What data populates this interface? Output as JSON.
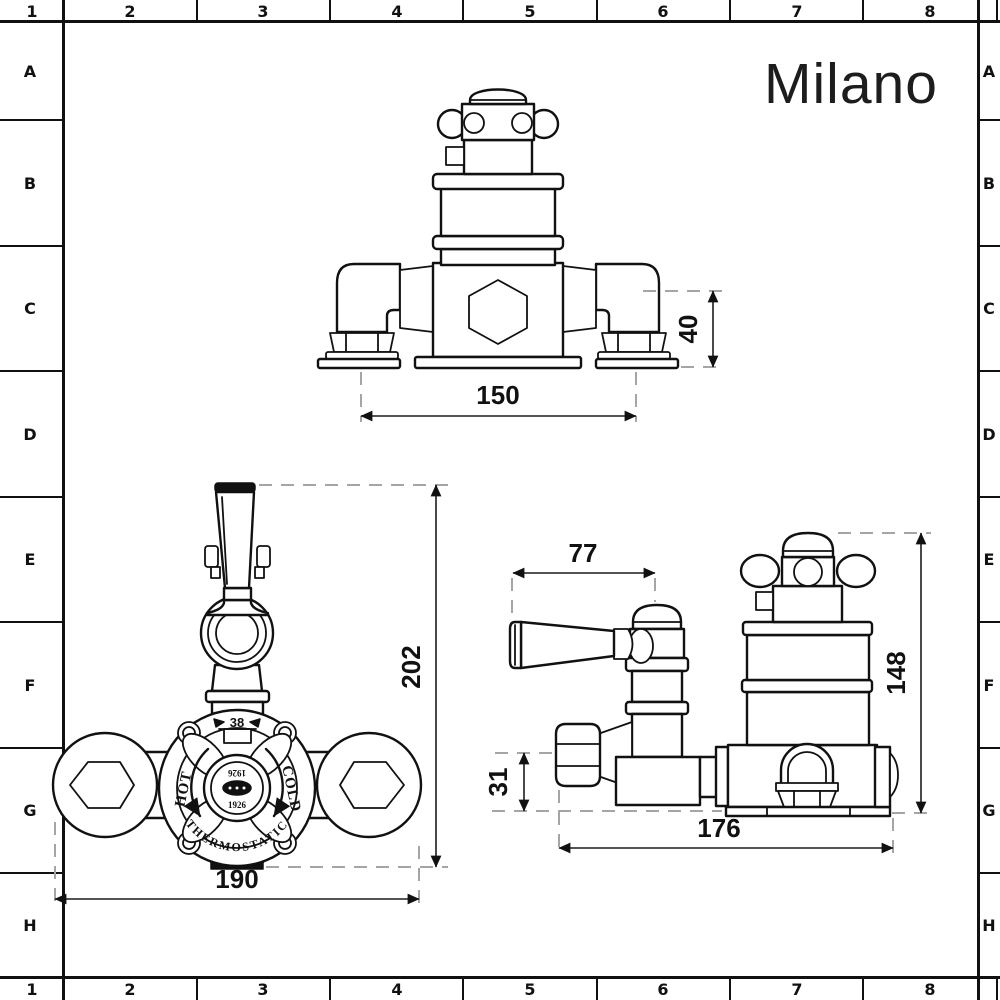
{
  "brand": {
    "logo": "Milano"
  },
  "grid": {
    "columns": [
      "1",
      "2",
      "3",
      "4",
      "5",
      "6",
      "7",
      "8"
    ],
    "rows": [
      "A",
      "B",
      "C",
      "D",
      "E",
      "F",
      "G",
      "H"
    ]
  },
  "dial": {
    "temp_marker": "38",
    "hot": "HOT",
    "cold": "COLD",
    "arc_label": "THERMOSTATIC",
    "badge_year_top": "1926",
    "badge_year_bottom": "1926"
  },
  "dims": {
    "front_top": {
      "width": "150",
      "depth": "40"
    },
    "front": {
      "height": "202",
      "width": "190"
    },
    "side": {
      "handle_reach": "77",
      "height": "148",
      "outlet_offset": "31",
      "depth": "176"
    }
  },
  "colors": {
    "ink": "#111111",
    "dim_extension": "#a5a5a5",
    "background": "#ffffff"
  }
}
